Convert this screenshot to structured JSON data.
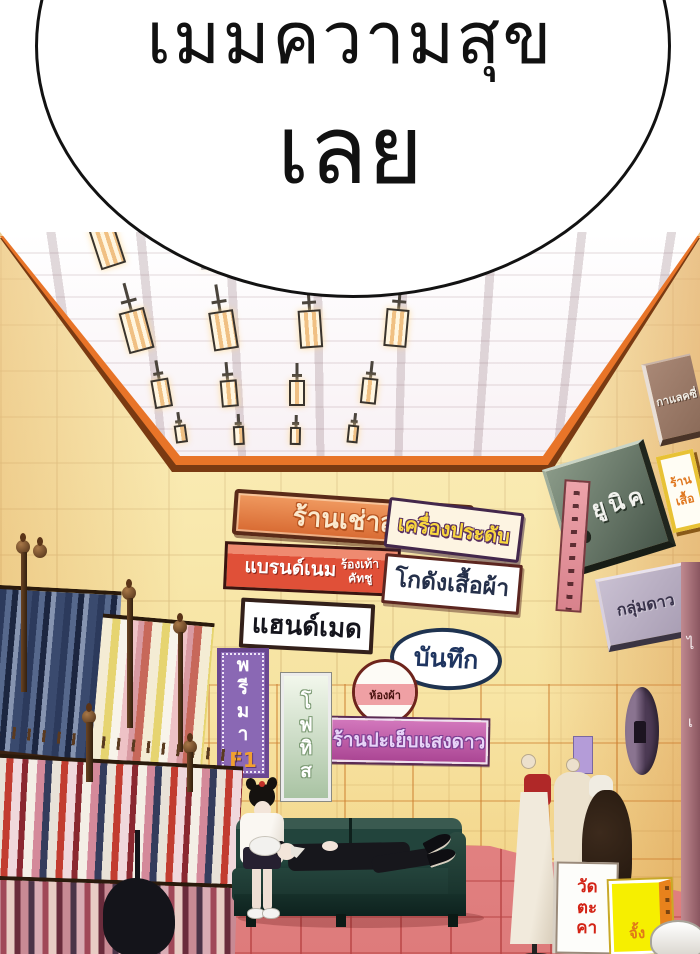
{
  "speech_bubble": {
    "line1": "เมมความสุข",
    "line2": "เลย"
  },
  "signs": {
    "suit_rental": "ร้านเช่าสูท",
    "brand_name": "แบรนด์เนม",
    "dress_shoes_line1": "ร้องเท้า",
    "dress_shoes_line2": "คัทชู",
    "jewelry": "เครื่องประดับ",
    "clothes_warehouse": "โกดังเสื้อผ้า",
    "handmade": "แฮนด์เมด",
    "note": "บันทึก",
    "fabric_room": "ห้องผ้า",
    "sewing_shop": "ร้านปะเย็บแสงดาว",
    "prima": "พ\nรี\nม\nา",
    "prima_sub": "F1",
    "photis": "โ\nฟ\nทิ\nส",
    "unique": "ยูนิค",
    "constellation": "กลุ่มดาว",
    "galaxy": "กาแลคซี่",
    "shirt_shop": "ร้านเสื้อ",
    "temple_board": "วัด\nตะ\nคา",
    "yellow_board": "จั้ง",
    "pillar_text_top": "ไ",
    "pillar_text_bottom": "เ"
  },
  "colors": {
    "bubble_outline": "#121212",
    "wall_tile": "#f5e29b",
    "ceiling_trim": "#e87428",
    "floor_tile": "#ef9090",
    "couch": "#22443c",
    "suit_sign": "#d86a32",
    "sewing_sign": "#ab4694",
    "prima_sign": "#8a68b4",
    "unique_sign": "#47564a"
  }
}
